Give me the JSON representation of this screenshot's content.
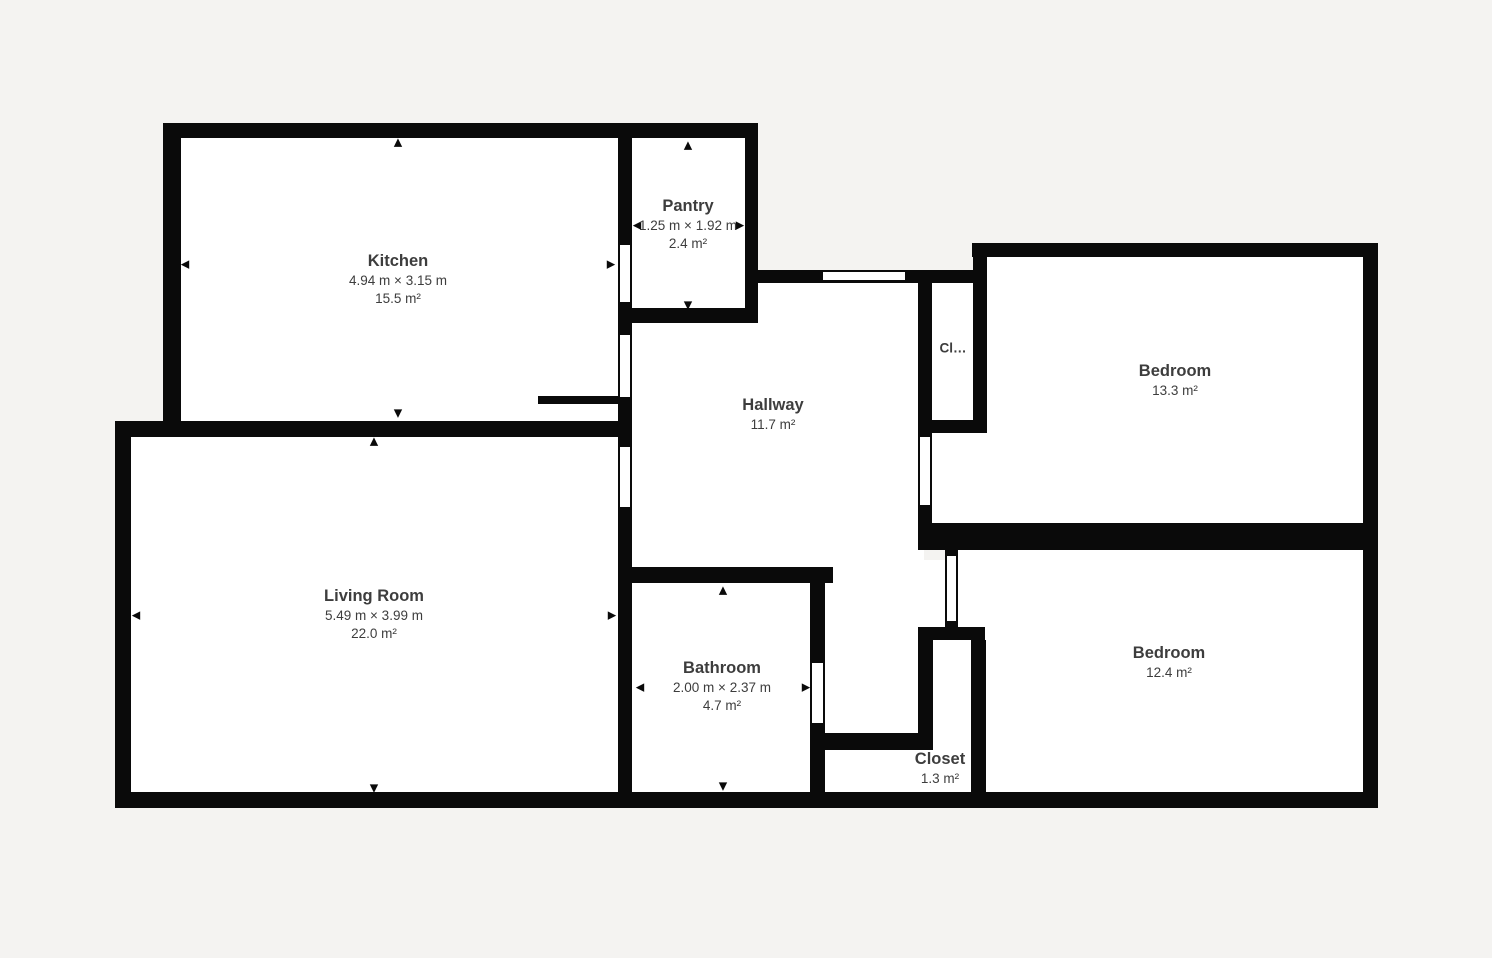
{
  "colors": {
    "background": "#f4f3f1",
    "wall": "#0a0a0a",
    "room_fill": "#ffffff",
    "label_text": "#3d3d3d"
  },
  "icons": {
    "arrow_up": "▲",
    "arrow_down": "▼",
    "arrow_left": "◀",
    "arrow_right": "▶"
  },
  "rooms": {
    "kitchen": {
      "name": "Kitchen",
      "dimensions": "4.94 m × 3.15 m",
      "area": "15.5 m²"
    },
    "pantry": {
      "name": "Pantry",
      "dimensions": "1.25 m × 1.92 m",
      "area": "2.4 m²"
    },
    "hallway": {
      "name": "Hallway",
      "area": "11.7 m²"
    },
    "closet_truncated": {
      "name": "Cl…"
    },
    "bedroom_top_right": {
      "name": "Bedroom",
      "area": "13.3 m²"
    },
    "bedroom_bottom_right": {
      "name": "Bedroom",
      "area": "12.4 m²"
    },
    "bathroom": {
      "name": "Bathroom",
      "dimensions": "2.00 m × 2.37 m",
      "area": "4.7 m²"
    },
    "closet": {
      "name": "Closet",
      "area": "1.3 m²"
    },
    "living_room": {
      "name": "Living Room",
      "dimensions": "5.49 m × 3.99 m",
      "area": "22.0 m²"
    }
  }
}
